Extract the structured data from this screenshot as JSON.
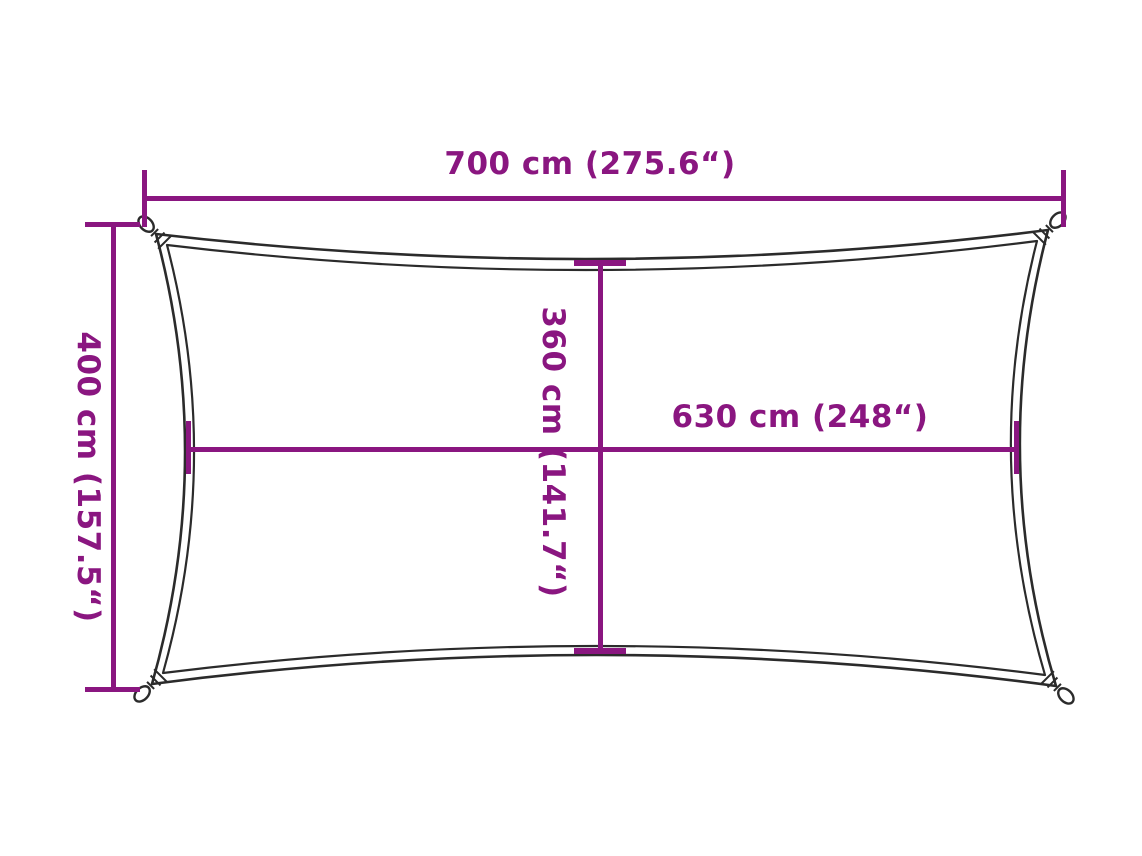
{
  "diagram": {
    "type": "product-dimension-diagram",
    "subject": "rectangular shade sail with concave edges and corner loops",
    "colors": {
      "dimension_lines": "#8A1680",
      "sail_outline": "#2B2B2B",
      "background": "#FFFFFF"
    },
    "dimensions": {
      "width_top": "700 cm (275.6“)",
      "height_left": "400 cm (157.5“)",
      "height_middle": "360 cm (141.7“)",
      "width_middle": "630 cm (248“)"
    }
  }
}
